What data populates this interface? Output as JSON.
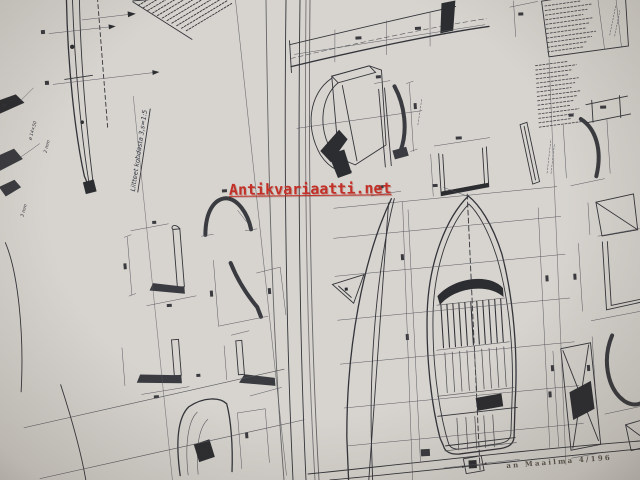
{
  "photo": {
    "watermark_text": "Antikvariaatti.net",
    "footer_text": "an Maailma 4/196"
  },
  "left_page": {
    "caption": "Liitteet kohdasta 3,s=1:5",
    "label_hole": "ø 14×50",
    "label_2mm": "2 mm",
    "label_3mm": "3 mm"
  },
  "colors": {
    "watermark_red": "#c23028",
    "page": "#d6d3ce",
    "gutter": "#e3c5a2",
    "ink": "#33343a"
  }
}
